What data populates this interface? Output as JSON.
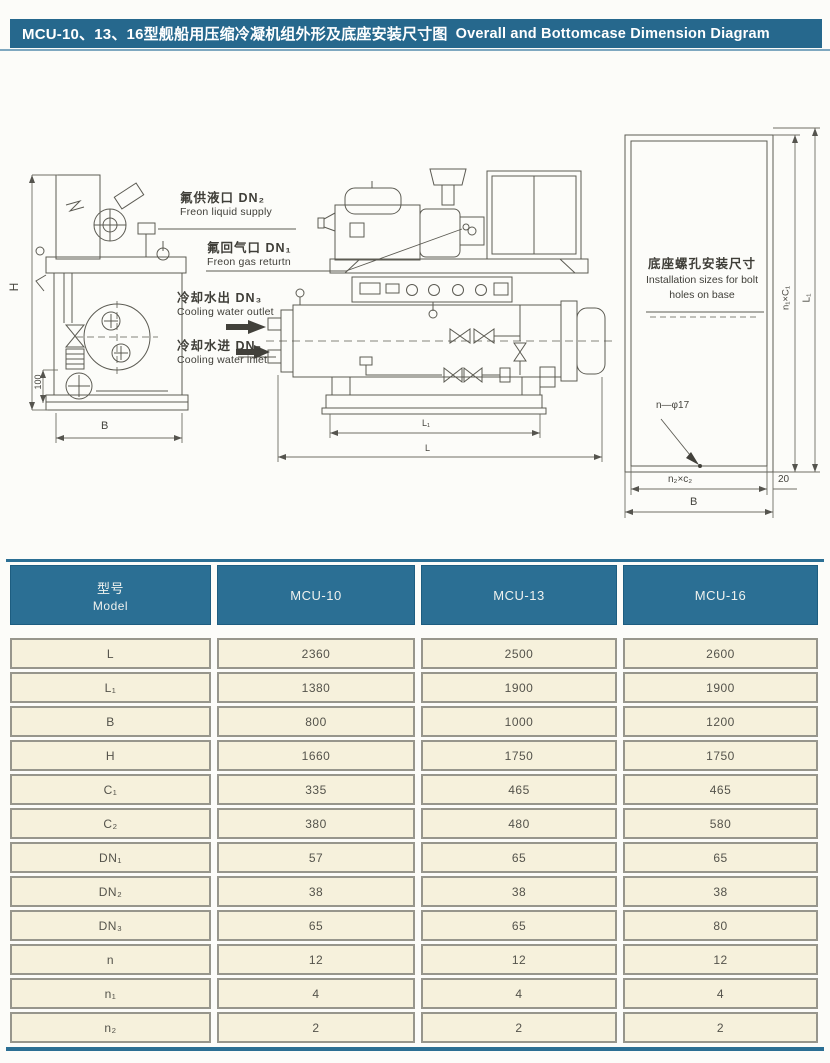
{
  "page": {
    "title_zh": "MCU-10、13、16型舰船用压缩冷凝机组外形及底座安装尺寸图",
    "title_en": "Overall and Bottomcase Dimension Diagram"
  },
  "colors": {
    "title_bar": "#26688d",
    "table_header": "#2b6f94",
    "cell_background": "#f6f1dc",
    "accent_line": "#7fa8c0"
  },
  "diagram": {
    "ports": {
      "freon_liquid": {
        "zh": "氟供液口 DN₂",
        "en": "Freon liquid supply"
      },
      "freon_gas": {
        "zh": "氟回气口 DN₁",
        "en": "Freon gas returtn"
      },
      "water_outlet": {
        "zh": "冷却水出 DN₃",
        "en": "Cooling water outlet"
      },
      "water_inlet": {
        "zh": "冷却水进 DN₃",
        "en": "Cooling water inlet"
      }
    },
    "base_note": {
      "zh": "底座螺孔安装尺寸",
      "en_line1": "Installation sizes for bolt",
      "en_line2": "holes on base"
    },
    "dims": {
      "height": "H",
      "foot": "100",
      "width_left": "B",
      "length_inner": "L₁",
      "length_outer": "L",
      "bolt_holes": "n—φ17",
      "bolt_span_bottom": "n₂×c₂",
      "base_width": "B",
      "edge_offset": "20",
      "bolt_span_side": "n₁×C₁",
      "length_side": "L₁"
    }
  },
  "table": {
    "header": {
      "model_zh": "型号",
      "model_en": "Model",
      "columns": [
        "MCU-10",
        "MCU-13",
        "MCU-16"
      ]
    },
    "rows": [
      {
        "param": "L",
        "values": [
          "2360",
          "2500",
          "2600"
        ]
      },
      {
        "param": "L₁",
        "values": [
          "1380",
          "1900",
          "1900"
        ]
      },
      {
        "param": "B",
        "values": [
          "800",
          "1000",
          "1200"
        ]
      },
      {
        "param": "H",
        "values": [
          "1660",
          "1750",
          "1750"
        ]
      },
      {
        "param": "C₁",
        "values": [
          "335",
          "465",
          "465"
        ]
      },
      {
        "param": "C₂",
        "values": [
          "380",
          "480",
          "580"
        ]
      },
      {
        "param": "DN₁",
        "values": [
          "57",
          "65",
          "65"
        ]
      },
      {
        "param": "DN₂",
        "values": [
          "38",
          "38",
          "38"
        ]
      },
      {
        "param": "DN₃",
        "values": [
          "65",
          "65",
          "80"
        ]
      },
      {
        "param": "n",
        "values": [
          "12",
          "12",
          "12"
        ]
      },
      {
        "param": "n₁",
        "values": [
          "4",
          "4",
          "4"
        ]
      },
      {
        "param": "n₂",
        "values": [
          "2",
          "2",
          "2"
        ]
      }
    ]
  }
}
